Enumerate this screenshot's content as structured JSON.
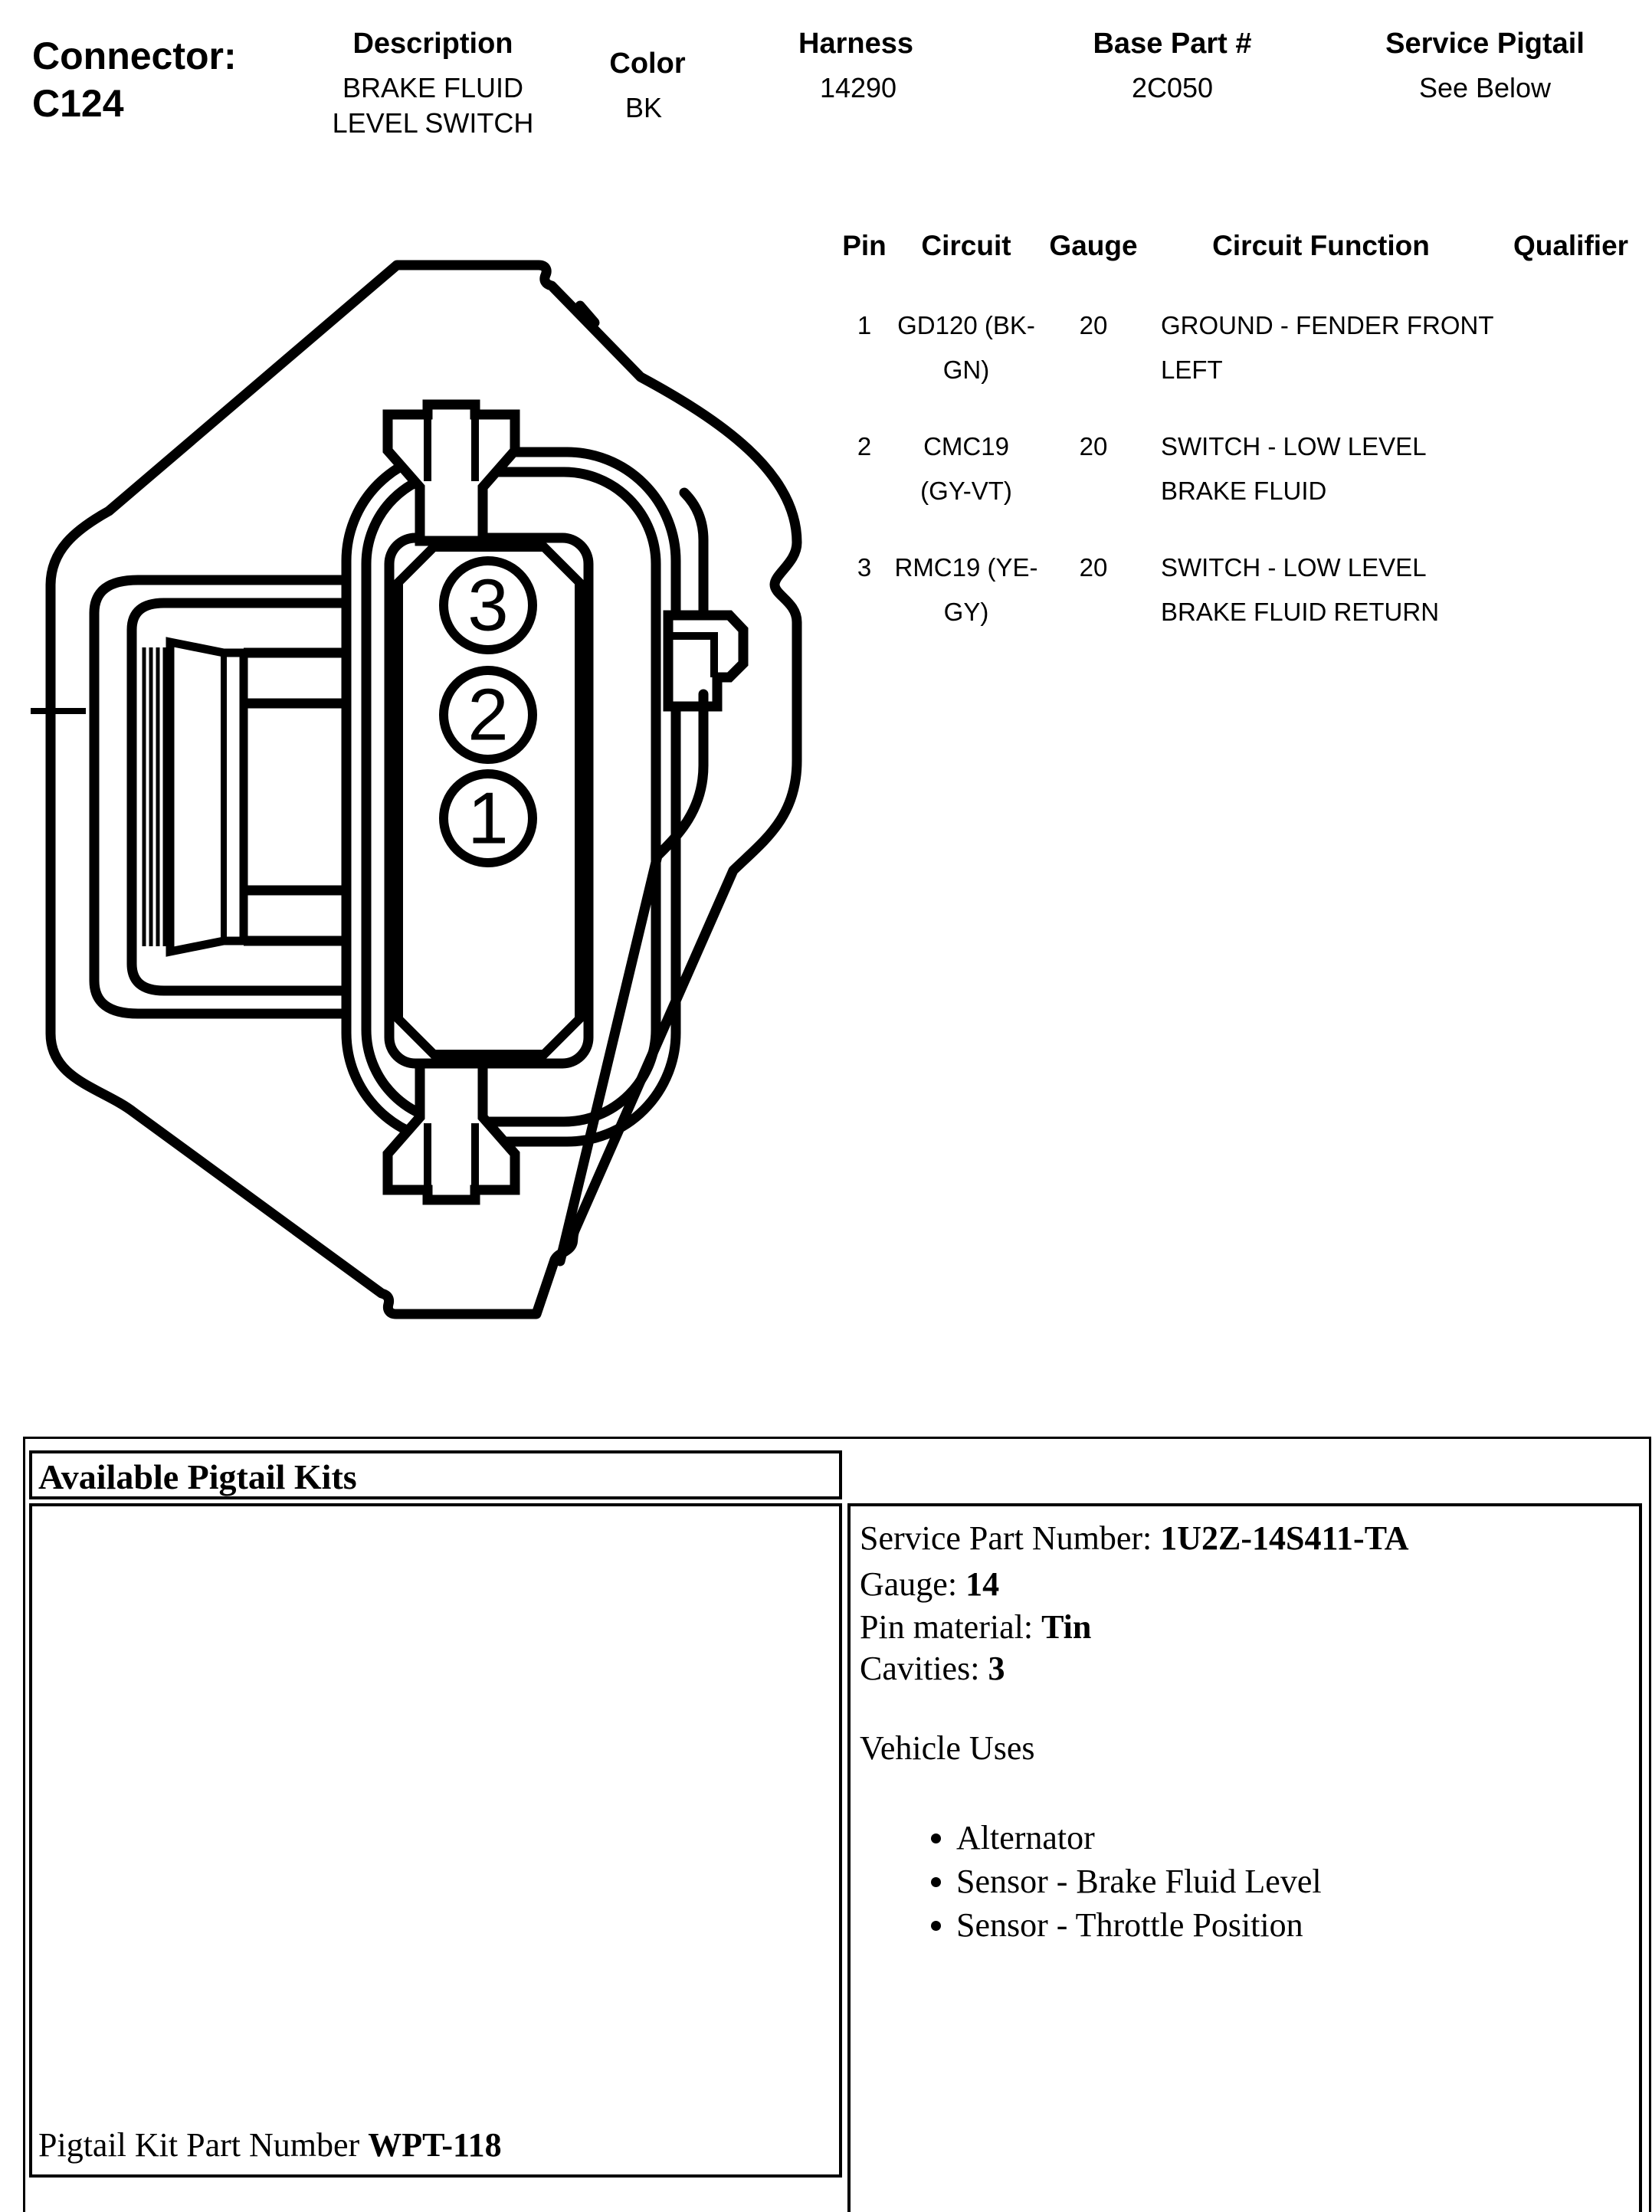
{
  "header": {
    "connector_label": "Connector:",
    "connector_id": "C124",
    "description_label": "Description",
    "description_lines": [
      "BRAKE FLUID",
      "LEVEL SWITCH"
    ],
    "color_label": "Color",
    "color_value": "BK",
    "harness_label": "Harness",
    "harness_value": "14290",
    "base_part_label": "Base Part #",
    "base_part_value": "2C050",
    "service_pigtail_label": "Service Pigtail",
    "service_pigtail_value": "See Below"
  },
  "pin_table": {
    "headers": {
      "pin": "Pin",
      "circuit": "Circuit",
      "gauge": "Gauge",
      "function": "Circuit Function",
      "qualifier": "Qualifier"
    },
    "rows": [
      {
        "pin": "1",
        "circuit_lines": [
          "GD120 (BK-",
          "GN)"
        ],
        "gauge": "20",
        "function_lines": [
          "GROUND - FENDER FRONT",
          "LEFT"
        ],
        "qualifier": ""
      },
      {
        "pin": "2",
        "circuit_lines": [
          "CMC19",
          "(GY-VT)"
        ],
        "gauge": "20",
        "function_lines": [
          "SWITCH - LOW LEVEL",
          "BRAKE FLUID"
        ],
        "qualifier": ""
      },
      {
        "pin": "3",
        "circuit_lines": [
          "RMC19 (YE-",
          "GY)"
        ],
        "gauge": "20",
        "function_lines": [
          "SWITCH - LOW LEVEL",
          "BRAKE FLUID RETURN"
        ],
        "qualifier": ""
      }
    ]
  },
  "diagram": {
    "cavity_labels": [
      "3",
      "2",
      "1"
    ]
  },
  "pigtail": {
    "title": "Available Pigtail Kits",
    "kit_label": "Pigtail Kit Part Number ",
    "kit_value": "WPT-118",
    "service": [
      {
        "label": "Service Part Number: ",
        "value": "1U2Z-14S411-TA"
      },
      {
        "label": "Gauge: ",
        "value": "14"
      },
      {
        "label": "Pin material: ",
        "value": "Tin"
      },
      {
        "label": "Cavities: ",
        "value": "3"
      }
    ],
    "vehicle_uses_title": "Vehicle Uses",
    "vehicle_uses": [
      "Alternator",
      "Sensor - Brake Fluid Level",
      "Sensor - Throttle Position"
    ]
  },
  "colors": {
    "ink": "#000000",
    "paper": "#ffffff"
  }
}
